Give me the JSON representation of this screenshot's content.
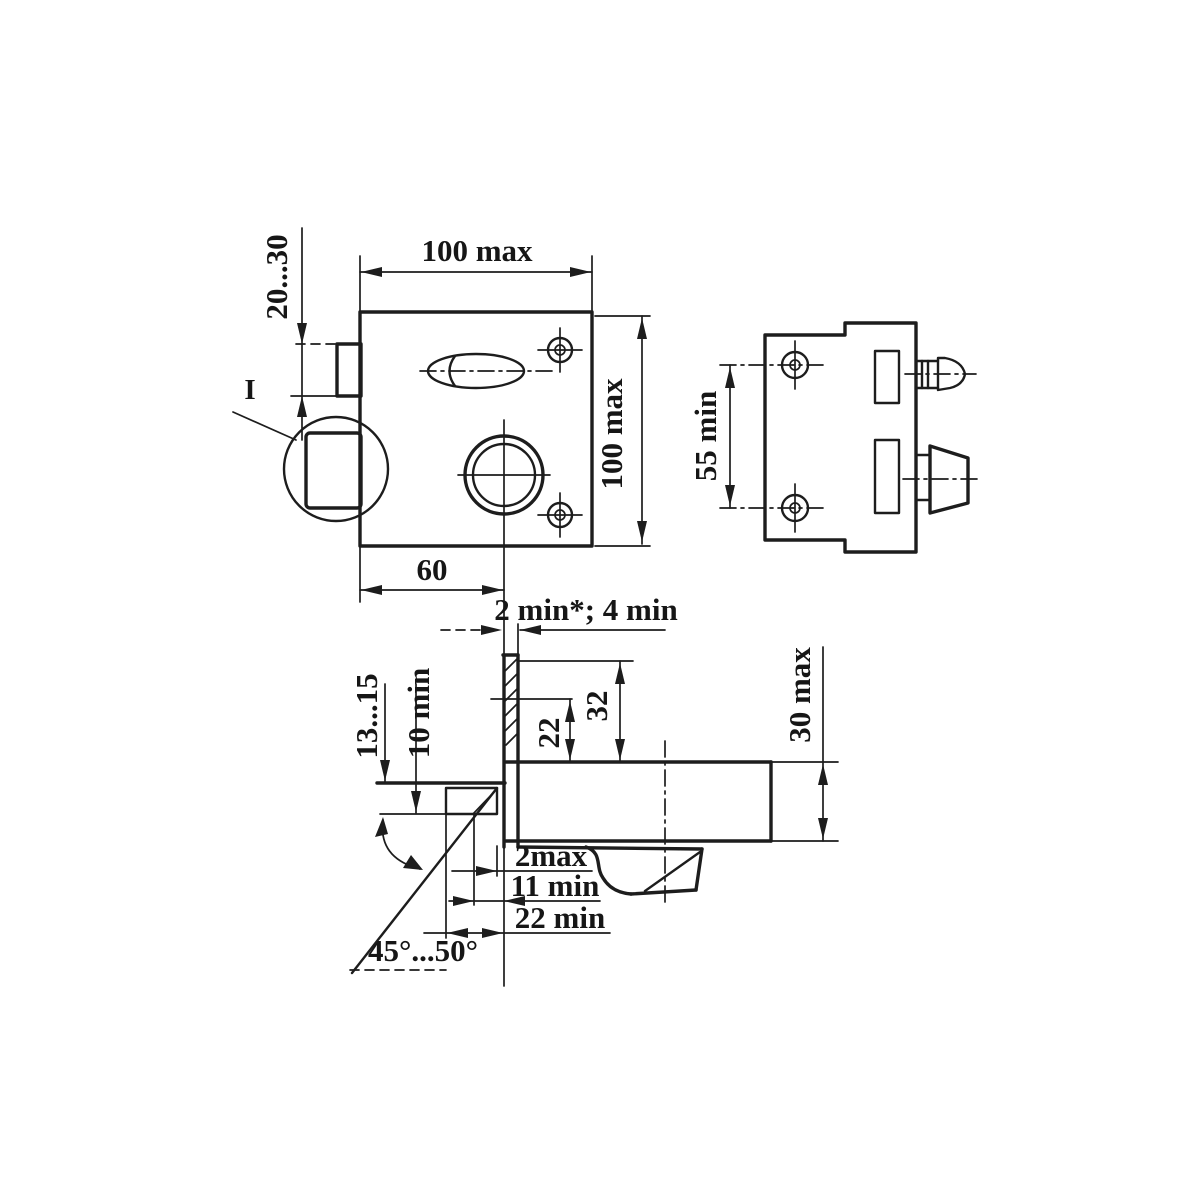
{
  "drawing": {
    "title": "rim-lock-dimension-drawing",
    "colors": {
      "ink": "#1d1d1d",
      "paper": "#ffffff"
    },
    "labels": {
      "front_width": "100 max",
      "front_height": "100 max",
      "follower_offset": "20...30",
      "detail_mark": "I",
      "backset": "60",
      "plate_thickness": "2 min*; 4 min",
      "hole_spacing": "55 min",
      "edge_depth_range": "13...15",
      "edge_depth_min": "10 min",
      "keyhole_offset": "22",
      "slot_offset": "32",
      "case_depth": "30 max",
      "gap_max": "2max",
      "latch_engagement": "11 min",
      "strike_depth": "22 min",
      "bevel_angle": "45°...50°"
    }
  }
}
